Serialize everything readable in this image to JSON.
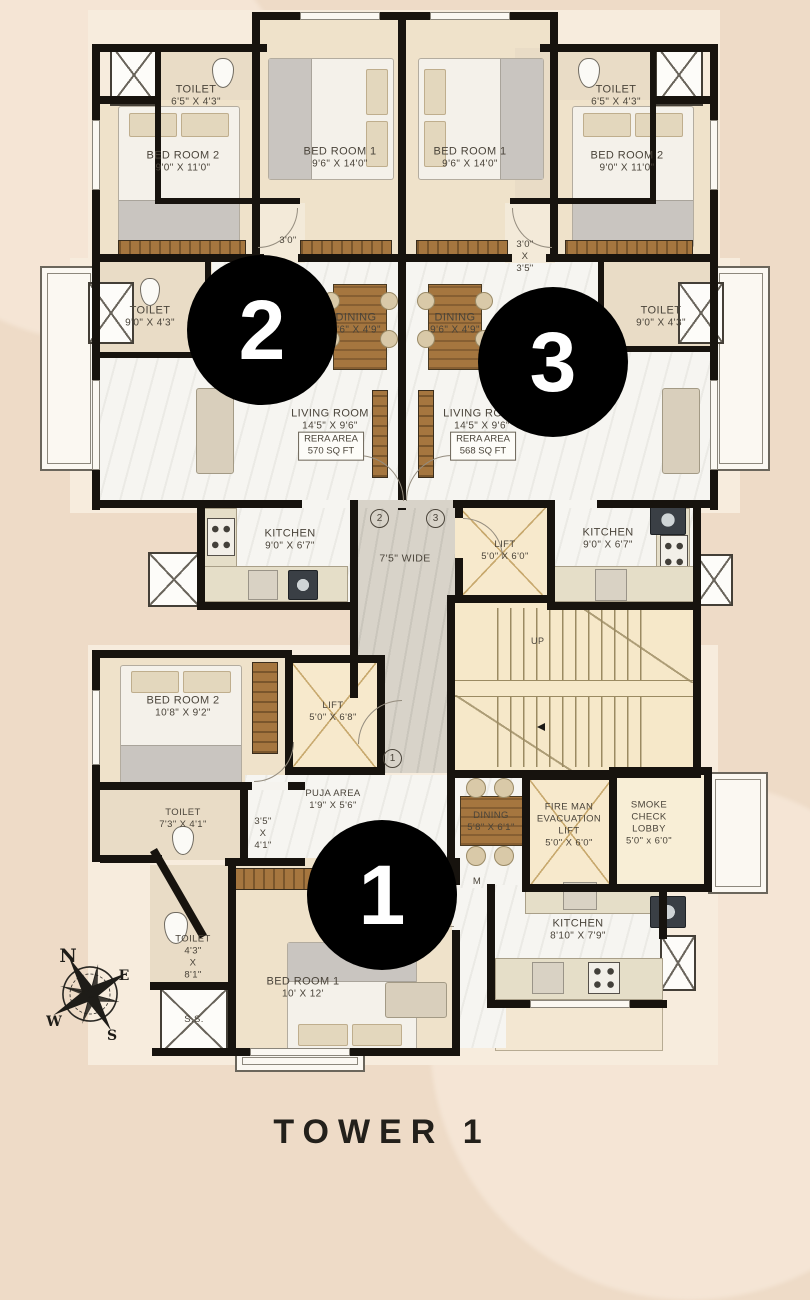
{
  "title": "TOWER 1",
  "colors": {
    "page_background": "#eedbc7",
    "walls": "#17130e",
    "unit_marker": "#000000",
    "label_text": "#4a443a"
  },
  "unit_markers": {
    "unit1": "1",
    "unit2": "2",
    "unit3": "3"
  },
  "door_markers": {
    "m1": "1",
    "m2": "2",
    "m3": "3"
  },
  "compass": {
    "n": "N",
    "e": "E",
    "w": "W",
    "s": "S",
    "c": "C"
  },
  "labels": {
    "t2_toilet": {
      "name": "TOILET",
      "dims": "6'5\" X 4'3\""
    },
    "t2_bed2": {
      "name": "BED ROOM 2",
      "dims": "9'0\" X 11'0\""
    },
    "t2_bed1": {
      "name": "BED ROOM 1",
      "dims": "9'6\" X 14'0\""
    },
    "t3_bed1": {
      "name": "BED ROOM 1",
      "dims": "9'6\" X 14'0\""
    },
    "t3_toilet": {
      "name": "TOILET",
      "dims": "6'5\" X 4'3\""
    },
    "t3_bed2": {
      "name": "BED ROOM 2",
      "dims": "9'0\" X 11'0\""
    },
    "t2_passage": {
      "dims": "3'0\""
    },
    "t3_passage": {
      "line1": "3'0\"",
      "line2": "X",
      "line3": "3'5\""
    },
    "t2_toilet2": {
      "name": "TOILET",
      "dims": "9'0\" X 4'3\""
    },
    "t2_dining": {
      "name": "DINING",
      "dims": "9'6\" X 4'9\""
    },
    "t3_dining": {
      "name": "DINING",
      "dims": "9'6\" X 4'9\""
    },
    "t3_toilet2": {
      "name": "TOILET",
      "dims": "9'0\" X 4'3\""
    },
    "t2_living": {
      "name": "LIVING ROOM",
      "dims": "14'5\" X 9'6\"",
      "rera1": "RERA AREA",
      "rera2": "570 SQ FT"
    },
    "t3_living": {
      "name": "LIVING ROOM",
      "dims": "14'5\" X 9'6\"",
      "rera1": "RERA AREA",
      "rera2": "568 SQ FT"
    },
    "t2_kitchen": {
      "name": "KITCHEN",
      "dims": "9'0\" X 6'7\""
    },
    "corridor": {
      "text": "7'5\" WIDE"
    },
    "lift_mid": {
      "name": "LIFT",
      "dims": "5'0\" X 6'0\""
    },
    "t3_kitchen": {
      "name": "KITCHEN",
      "dims": "9'0\" X 6'7\""
    },
    "stairs": {
      "up": "UP"
    },
    "u1_bed2": {
      "name": "BED ROOM 2",
      "dims": "10'8\" X 9'2\""
    },
    "u1_lift": {
      "name": "LIFT",
      "dims": "5'0\" X 6'8\""
    },
    "u1_puja": {
      "name": "PUJA AREA",
      "dims": "1'9\" X 5'6\""
    },
    "u1_toilet1": {
      "name": "TOILET",
      "dims": "7'3\" X 4'1\""
    },
    "u1_passage": {
      "line1": "3'5\"",
      "line2": "X",
      "line3": "4'1\""
    },
    "u1_dining": {
      "name": "DINING",
      "dims": "5'8\" X 6'1\""
    },
    "fireman": {
      "line1": "FIRE MAN",
      "line2": "EVACUATION",
      "line3": "LIFT",
      "dims": "5'0\" X 6'0\""
    },
    "smoke": {
      "line1": "SMOKE",
      "line2": "CHECK",
      "line3": "LOBBY",
      "dims": "5'0\" x 6'0\""
    },
    "u1_living_partial": {
      "text": "M"
    },
    "u1_toilet2": {
      "name": "TOILET",
      "line1": "4'3\"",
      "line2": "X",
      "line3": "8'1\""
    },
    "ss": {
      "text": "S.S."
    },
    "u1_bed1": {
      "name": "BED ROOM 1",
      "dims": "10' X 12'"
    },
    "u1_kitchen": {
      "name": "KITCHEN",
      "dims": "8'10\" X 7'9\""
    }
  }
}
